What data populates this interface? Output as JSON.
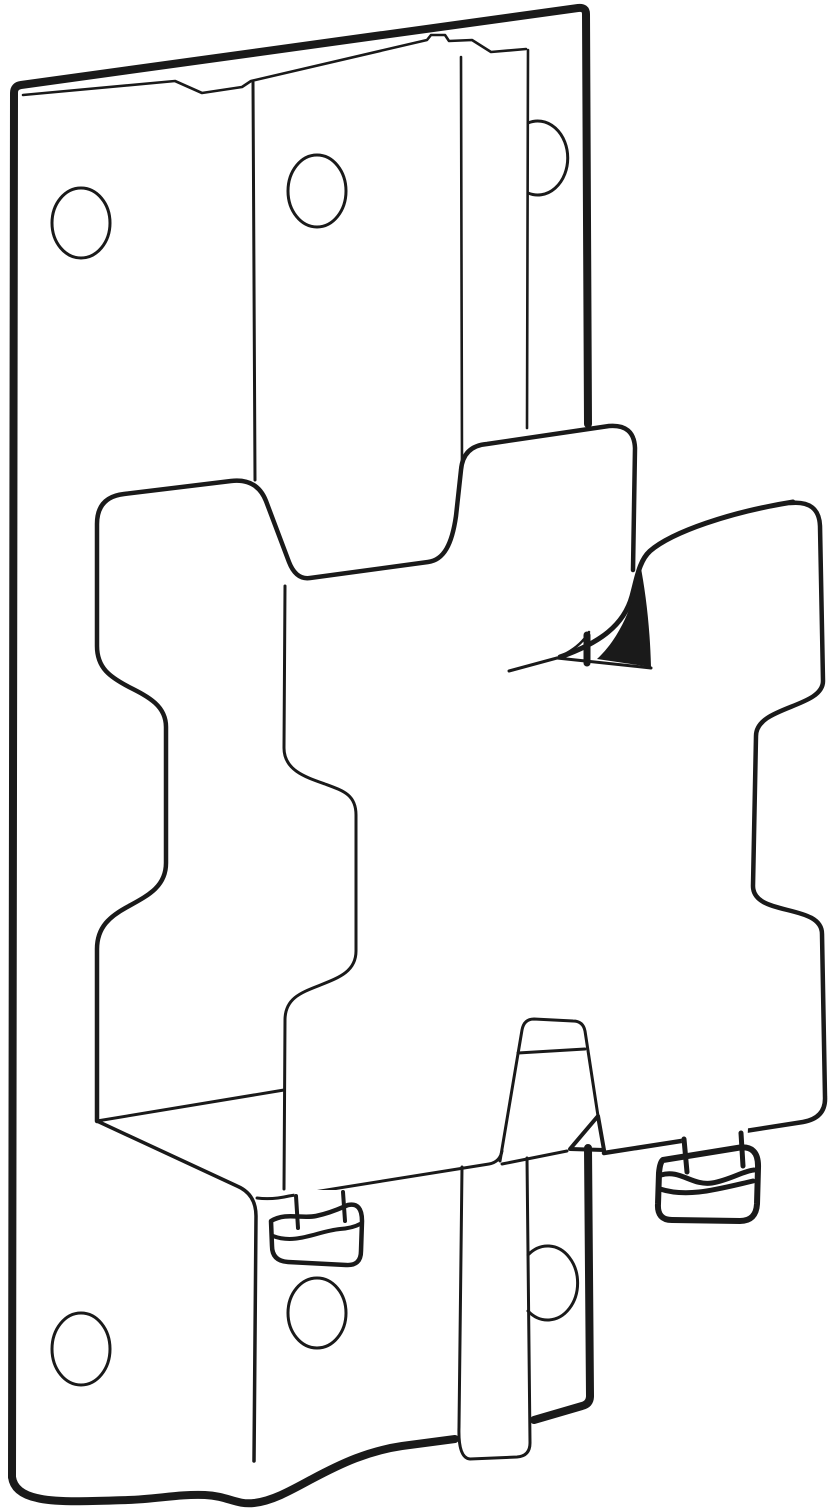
{
  "artwork": {
    "type": "technical-line-drawing",
    "background_color": "#ffffff",
    "line_color": "#1a1a1a",
    "subject": "Wall-mount bracket with vertical rail, sliding cradle and quick-release VESA plate secured by two thumbscrews",
    "parts": [
      "wall-plate",
      "top-hem-and-hook-slot",
      "mounting-rail",
      "screw-holes",
      "cradle-shelf",
      "rear-bracket-tab",
      "front-vesa-plate",
      "hook-beak",
      "left-thumbscrew",
      "right-thumbscrew",
      "rail-foot"
    ]
  }
}
